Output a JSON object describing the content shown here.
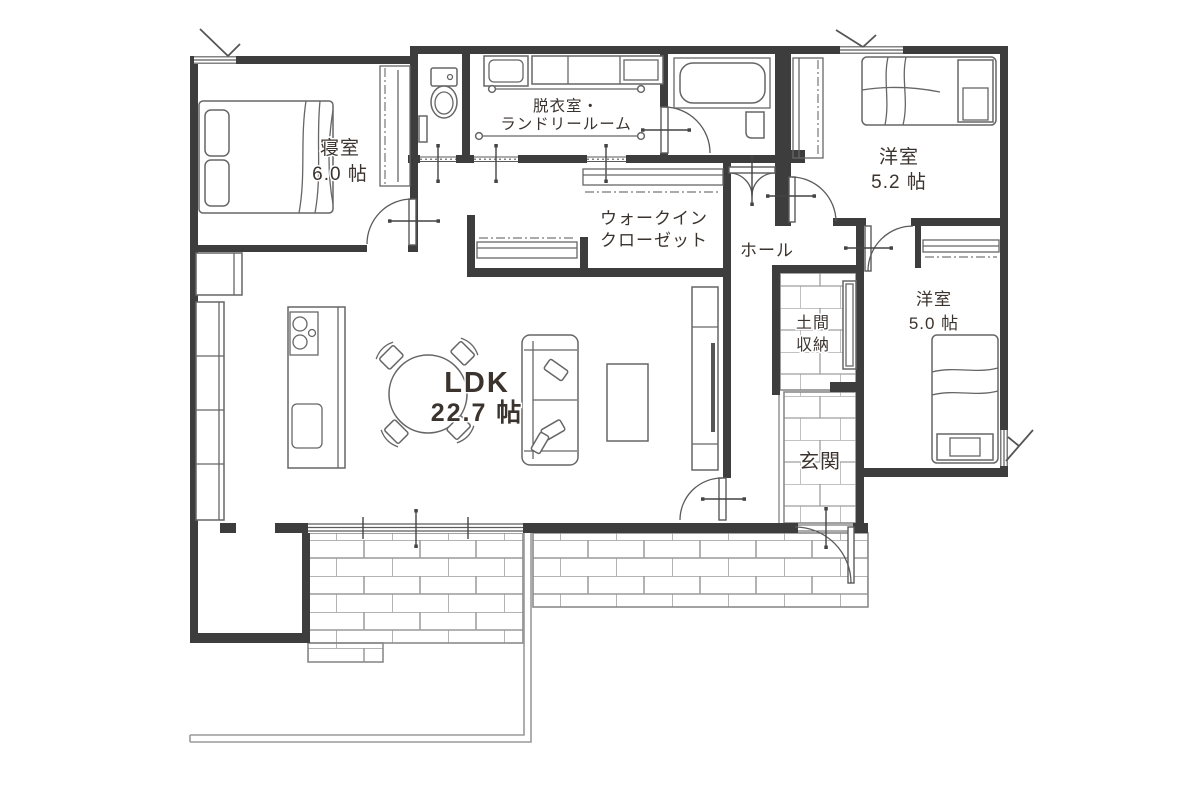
{
  "rooms": {
    "bedroom": {
      "name": "寝室",
      "area": "6.0 帖"
    },
    "laundry": {
      "line1": "脱衣室・",
      "line2": "ランドリールーム"
    },
    "wic": {
      "line1": "ウォークイン",
      "line2": "クローゼット"
    },
    "western_5_2": {
      "name": "洋室",
      "area": "5.2 帖"
    },
    "hall": {
      "name": "ホール"
    },
    "doma_storage": {
      "line1": "土間",
      "line2": "収納"
    },
    "genkan": {
      "name": "玄関"
    },
    "western_5_0": {
      "name": "洋室",
      "area": "5.0 帖"
    },
    "ldk": {
      "name": "LDK",
      "area": "22.7 帖"
    }
  },
  "colors": {
    "wall": "#3d3d3d",
    "furniture_line": "#666666",
    "text": "#3b332e",
    "brick_line": "#999999"
  }
}
